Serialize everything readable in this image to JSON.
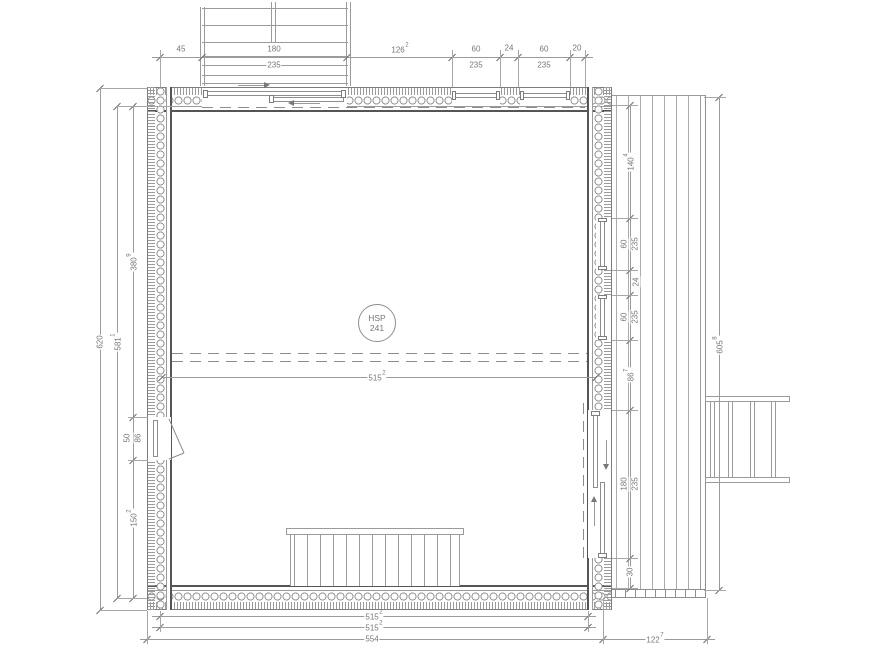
{
  "stamp": {
    "l1": "HSP",
    "l2": "241"
  },
  "dims": {
    "top45": "45",
    "top180a": "180",
    "top180b": "235",
    "top126v": "126",
    "top126s": "2",
    "top60a1": "60",
    "top60a2": "235",
    "top24": "24",
    "top60b1": "60",
    "top60b2": "235",
    "top20": "20",
    "left620": "620",
    "left581v": "581",
    "left581s": "1",
    "left380v": "380",
    "left380s": "9",
    "left50": "50",
    "left86": "86",
    "left150v": "150",
    "left150s": "2",
    "right140v": "140",
    "right140s": "4",
    "right60a1": "60",
    "right60a2": "235",
    "right24": "24",
    "right60b1": "60",
    "right60b2": "235",
    "right86v": "86",
    "right86s": "7",
    "right180a": "180",
    "right180b": "235",
    "right30": "30",
    "far605v": "605",
    "far605s": "8",
    "mid515v": "515",
    "mid515s": "2",
    "bot515av": "515",
    "bot515as": "2",
    "bot515bv": "515",
    "bot515bs": "2",
    "bot554": "554",
    "bot122v": "122",
    "bot122s": "7"
  },
  "colors": {
    "line": "#9b9b9b",
    "wall_inner": "#555555",
    "text": "#777777"
  }
}
